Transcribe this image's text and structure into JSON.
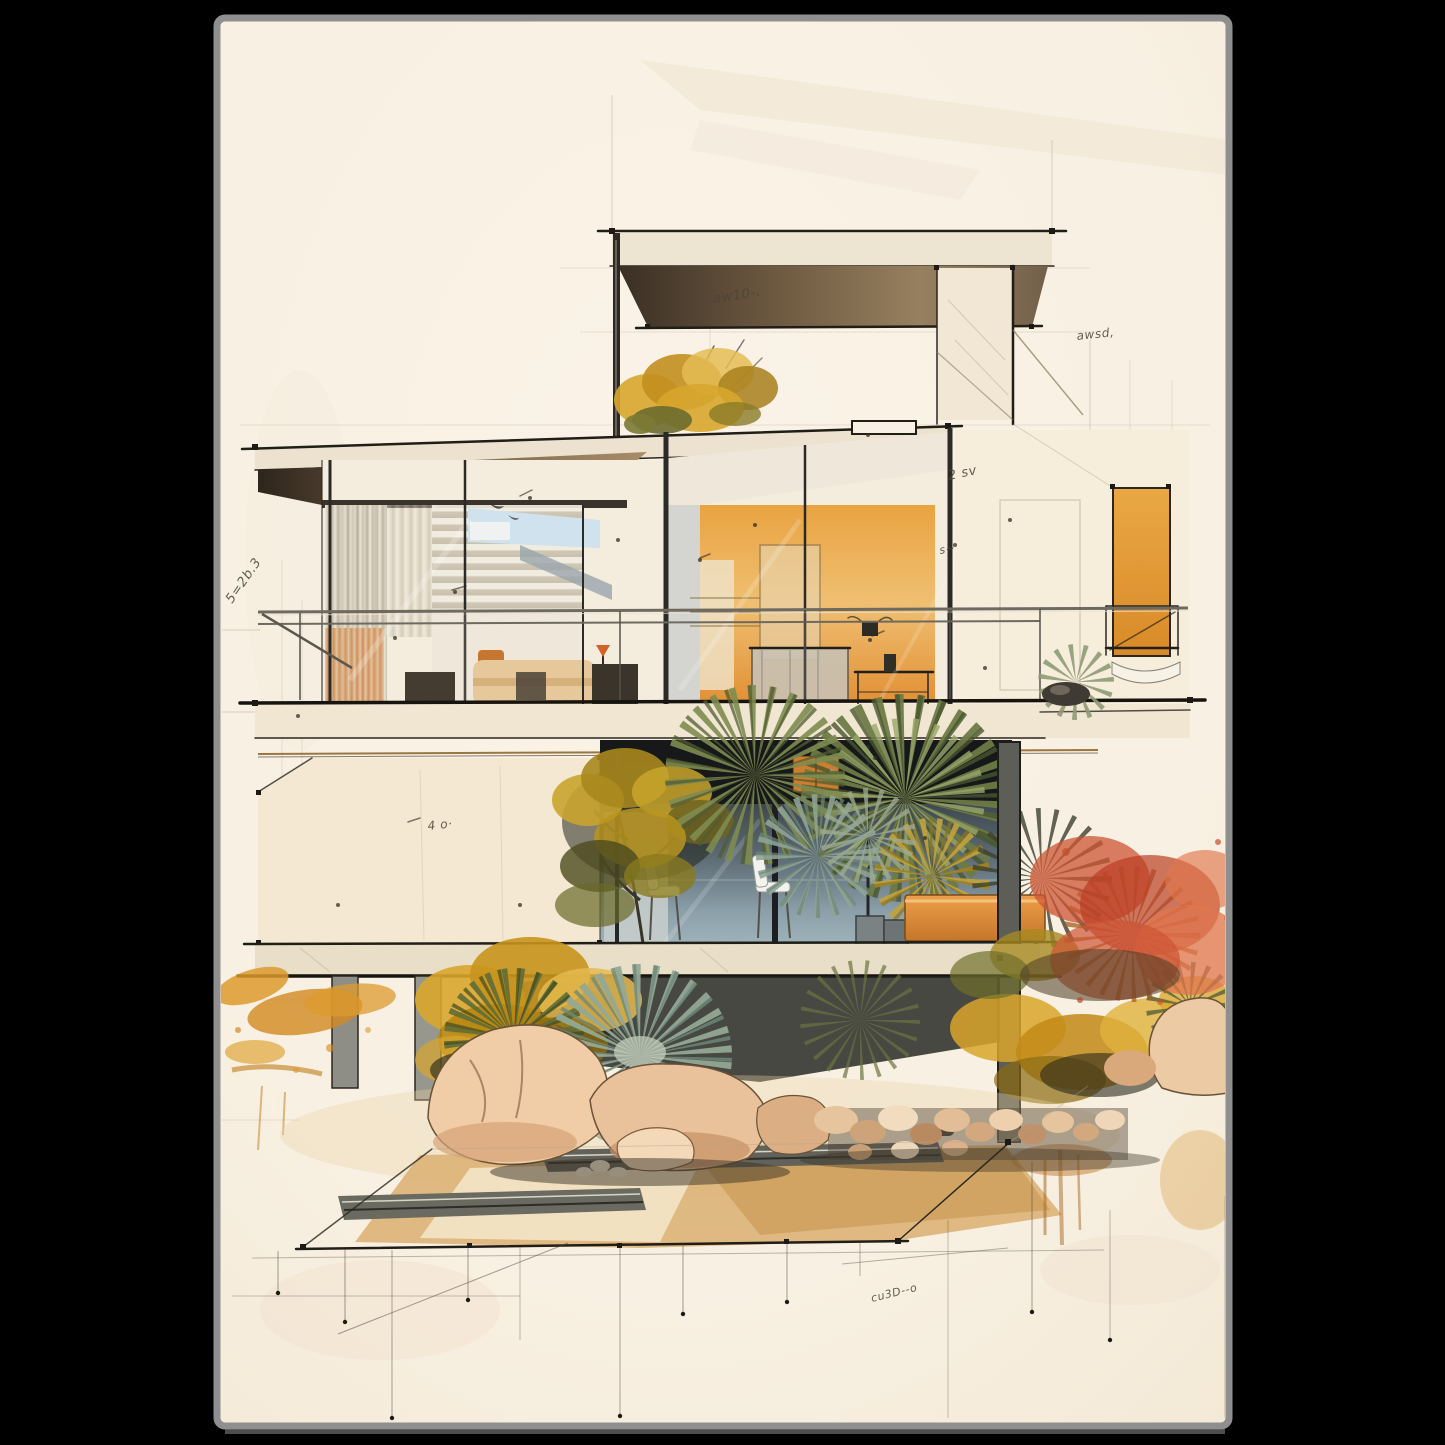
{
  "scene": {
    "kind": "wall-art poster of an architectural watercolor sketch",
    "subject": "two-storey modernist glass house on stilts with desert garden, rocks and paved path",
    "background_color": "#000000",
    "poster": {
      "paper_color": "#f8f0e2",
      "edge_color": "#8f8f8f"
    }
  },
  "palette": {
    "bg": "#000000",
    "paper": "#f8f0e2",
    "edge": "#8f8f8f",
    "ink": "#2b261f",
    "annotation": "#4a4436",
    "cream_slab": "#ece2cf",
    "soffit_dark": "#3c3127",
    "soffit_light": "#9a8165",
    "orange_interior": "#e09a38",
    "orange_window": "#e9a844",
    "orange_planter": "#d98a3c",
    "orange_cabinet": "#cd7d2f",
    "glass_blue": "#8fa3ad",
    "glass_dark": "#3d464e",
    "band_black": "#17181a",
    "curtain": "#d8cfc0",
    "curtain_orange": "#d98f55",
    "bed_duvet": "#e7c89b",
    "olive": "#6d7a46",
    "sage": "#8fa396",
    "teal_fan": "#92a795",
    "yellow_bush": "#d1a32c",
    "ochre": "#b8860f",
    "red_bush": "#cd5434",
    "rock": "#f0cda6",
    "rock_shade": "#cf9f74",
    "path_tan": "#dcb277",
    "steel_channel": "#62625a",
    "chair_white": "#f2f2ee",
    "column_gray": "#8e8e86",
    "gold_cap": "#8a6226",
    "sky_reflection": "#cfe2ee"
  },
  "annotations": {
    "a1": "5=2b.3",
    "a2": "aw10-.",
    "a3": "awsd,",
    "a4": "2 sv",
    "a5": "s~",
    "a6": "4 o·",
    "a7": "cu3D--o"
  }
}
